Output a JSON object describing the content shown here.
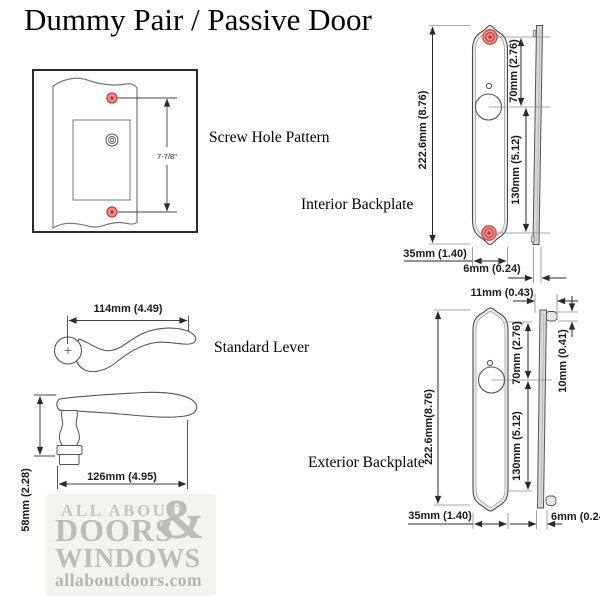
{
  "title": "Dummy Pair / Passive Door",
  "screw_pattern": {
    "label": "Screw Hole Pattern",
    "hole_spacing": "7-7/8\""
  },
  "lever": {
    "label": "Standard Lever",
    "top_length": "114mm (4.49)",
    "side_length": "126mm (4.95)",
    "height": "58mm (2.28)"
  },
  "interior": {
    "label": "Interior Backplate",
    "height": "222.6mm (8.76)",
    "top_to_center": "70mm (2.76)",
    "center_to_bottom": "130mm (5.12)",
    "width": "35mm (1.40)",
    "thickness": "6mm (0.24)"
  },
  "exterior": {
    "label": "Exterior Backplate",
    "height": "222.6mm(8.76)",
    "top_to_center": "70mm (2.76)",
    "center_to_bottom": "130mm (5.12)",
    "width": "35mm (1.40)",
    "thickness": "6mm (0.24)",
    "tab_depth": "11mm (0.43)",
    "tab_height": "10mm (0.41)"
  },
  "watermark": {
    "line1": "ALL ABOUT",
    "amp": "&",
    "line2": "DOORS",
    "line3": "WINDOWS",
    "url": "allaboutdoors.com"
  },
  "colors": {
    "screw_red_fill": "#ef8e87",
    "screw_red_ring": "#b93a34",
    "line": "#4a4a4a",
    "plate_bevel": "#ececec",
    "profile_gray": "#d8d8d8",
    "logo_gray": "#bcbcb9"
  }
}
